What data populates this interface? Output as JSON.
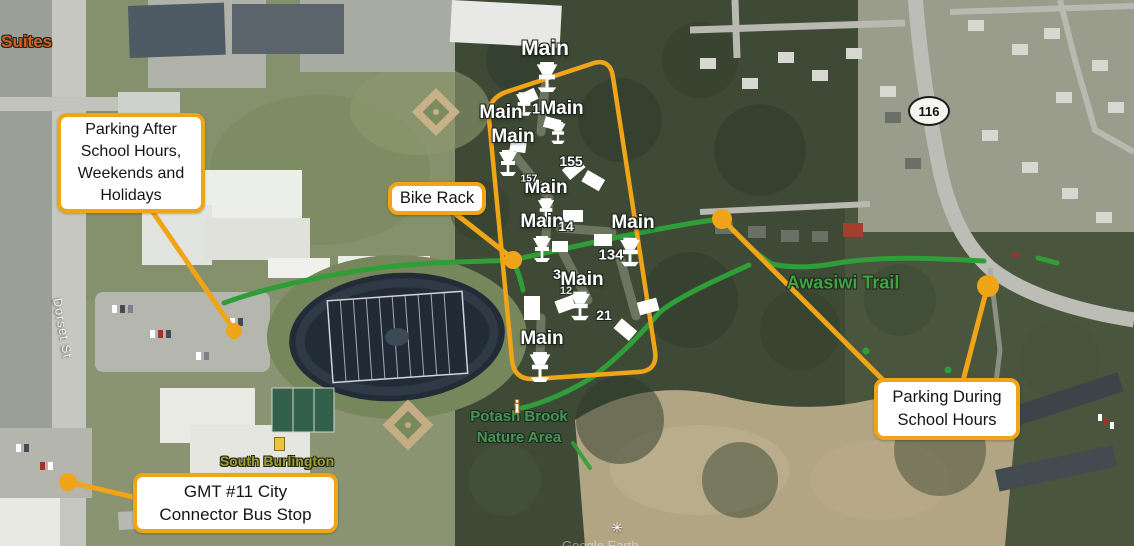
{
  "annotations": {
    "parking_after": "Parking After School Hours, Weekends and Holidays",
    "bike_rack": "Bike Rack",
    "parking_during": "Parking During School Hours",
    "gmt_bus_stop": "GMT #11 City Connector Bus Stop"
  },
  "course": {
    "hole_label": "Main",
    "numbers": {
      "n1": "1",
      "n155": "155",
      "n157": "157",
      "n14": "14",
      "n134": "134",
      "n3": "3",
      "n12": "12",
      "n21": "21"
    }
  },
  "map_labels": {
    "suites": "n Suites",
    "dorset_st": "Dorset St",
    "south_burlington": "South Burlington",
    "awasiwi_trail": "Awasiwi Trail",
    "potash_line1": "Potash Brook",
    "potash_line2": "Nature Area",
    "route_shield": "116",
    "watermark": "Google Earth"
  },
  "icons": {
    "info": "i",
    "spring": "✳"
  },
  "colors": {
    "annotation_orange": "#F0A417",
    "trail_green": "#2F9E38",
    "trail_label_green": "#3FA33F",
    "city_label_olive": "#A39C2E",
    "suites_orange": "#D95E1E"
  }
}
